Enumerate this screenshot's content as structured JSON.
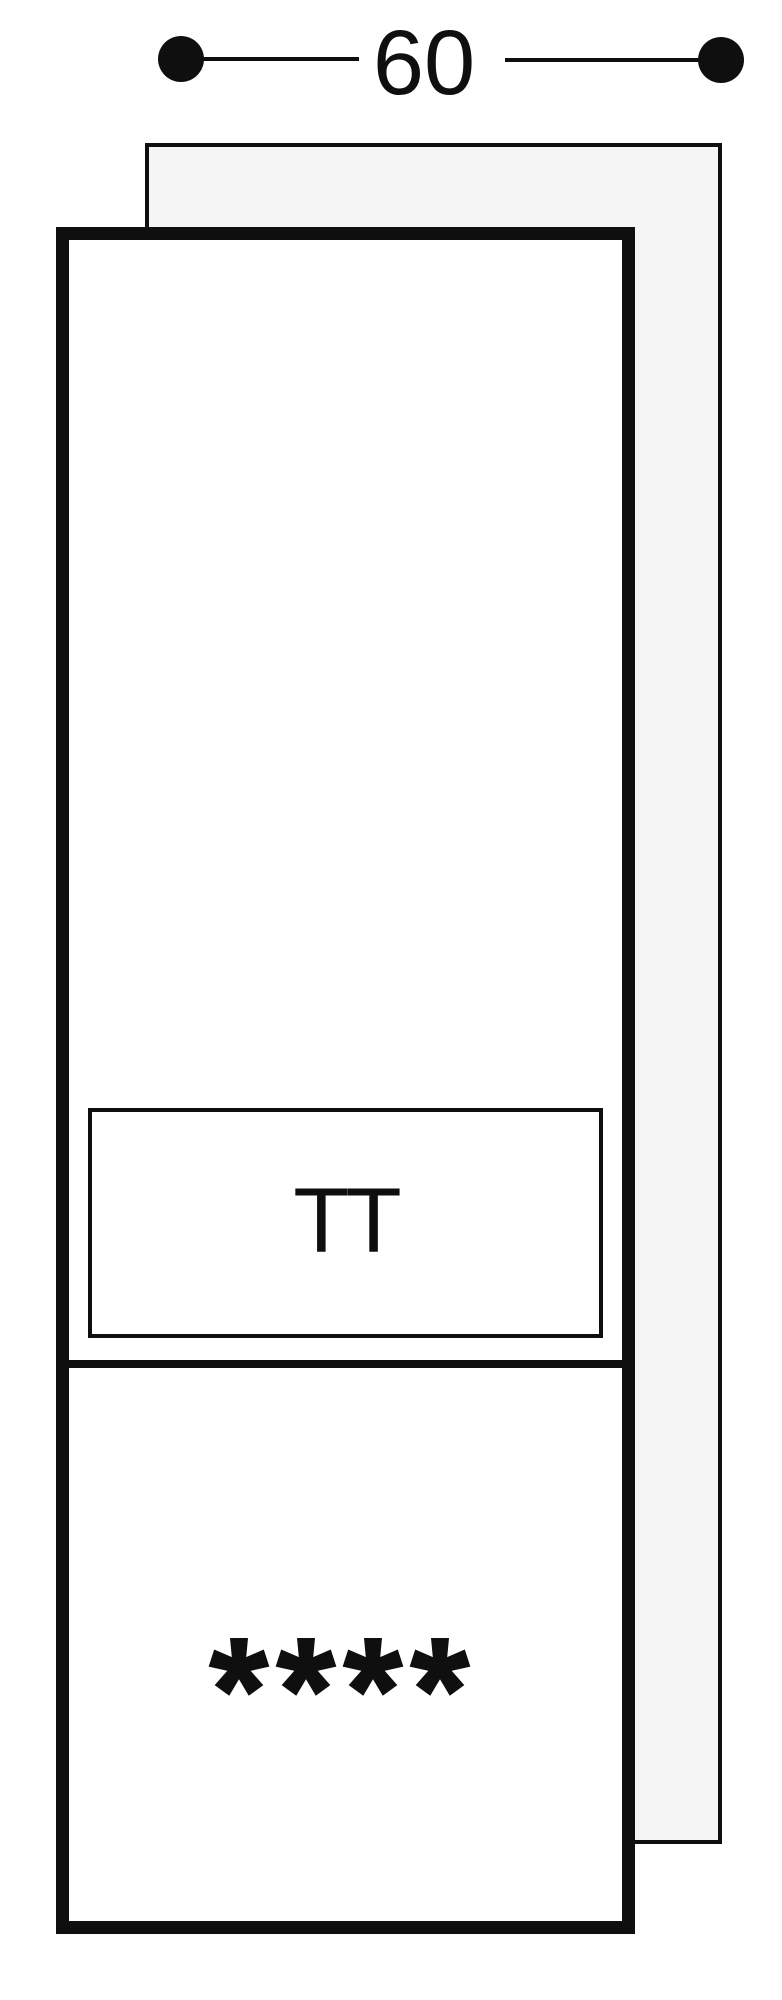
{
  "dimension": {
    "label": "60"
  },
  "appliance": {
    "fridge_panel_label": "TT",
    "freezer_stars": 4,
    "freezer_stars_glyph": "****"
  },
  "colors": {
    "line": "#0f0f0f",
    "niche_fill": "#f5f5f5",
    "appliance_fill": "#ffffff",
    "background": "#ffffff"
  },
  "icons": {
    "dimension_endpoints": "filled-circle",
    "freezer_rating_icon": "five-armed-asterisk"
  }
}
